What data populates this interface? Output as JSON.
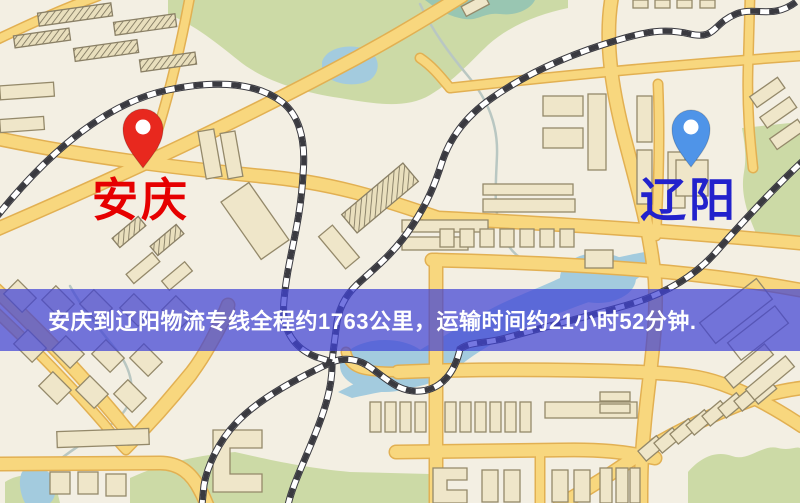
{
  "map": {
    "origin": {
      "label": "安庆",
      "marker": "red-pin"
    },
    "destination": {
      "label": "辽阳",
      "marker": "blue-pin"
    },
    "banner": {
      "text": "安庆到辽阳物流专线全程约1763公里，运输时间约21小时52分钟."
    },
    "colors": {
      "map_bg": "#f3efe3",
      "road": "#f8d77e",
      "park": "#ccdaa6",
      "water": "#a3cbde",
      "building": "#efe6c9",
      "railway": "#3a3a40",
      "origin_pin": "#e8281e",
      "destination_pin": "#4f94e8",
      "origin_label": "#e60000",
      "destination_label": "#2222cc",
      "banner_bg": "rgba(64,66,214,0.72)",
      "banner_text": "#ffffff"
    }
  }
}
